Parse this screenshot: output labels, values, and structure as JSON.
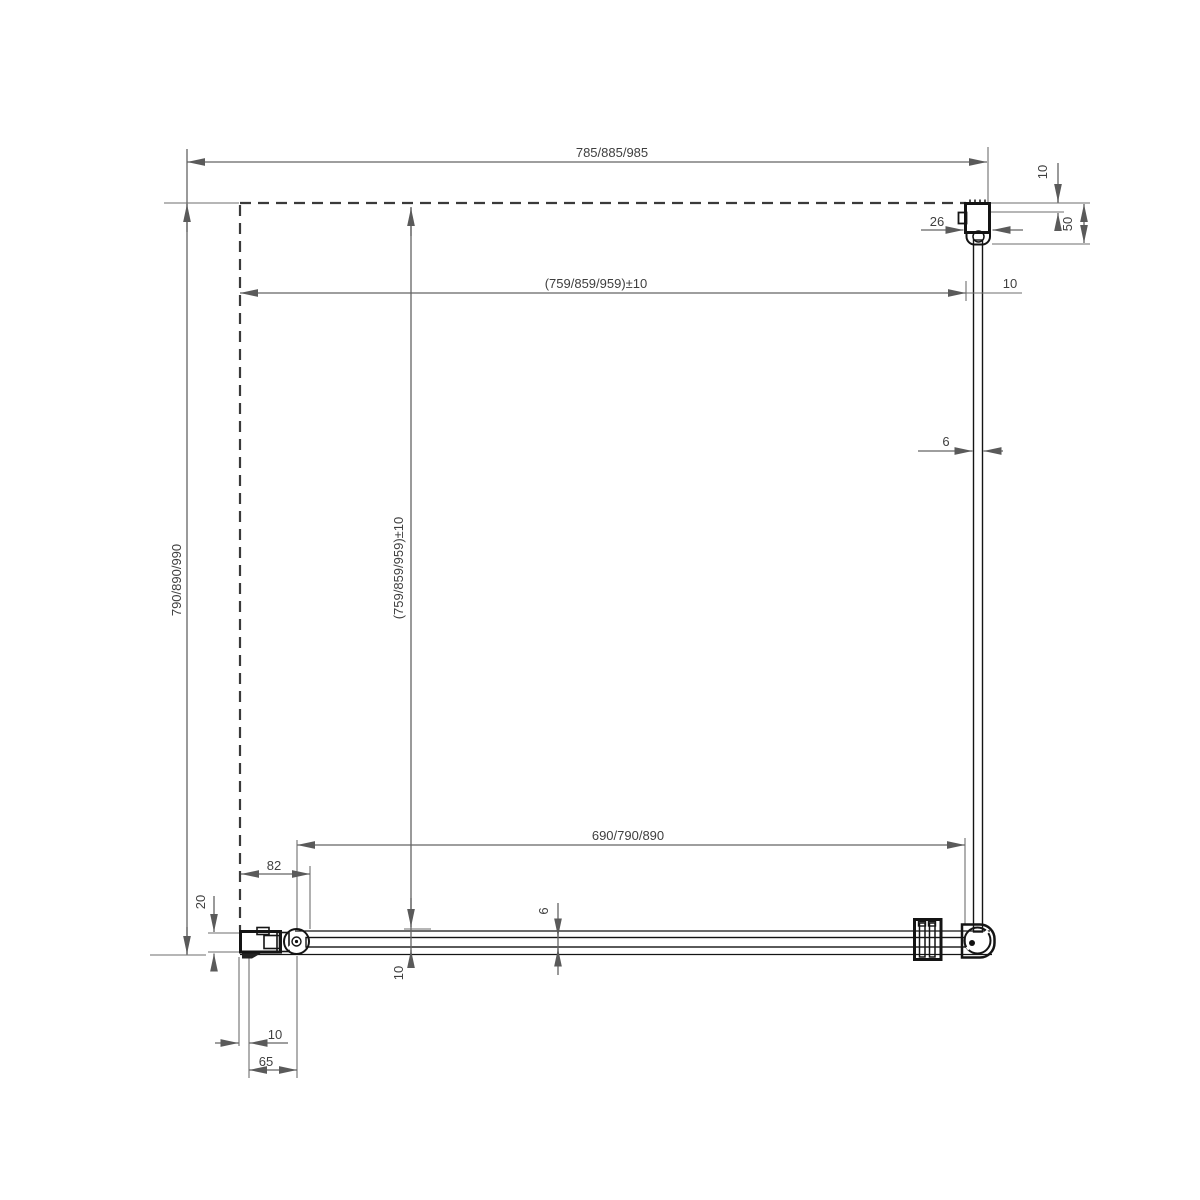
{
  "drawing": {
    "type": "technical-plan-drawing",
    "subject": "corner shower enclosure top view with wall profiles, hinge and corner connector",
    "line_color": "#141414",
    "dimension_color": "#636363",
    "background": "#ffffff",
    "dimensions": {
      "overall_width_top": "785/885/985",
      "inner_width_top": "(759/859/959)±10",
      "overall_depth_left": "790/890/990",
      "inner_depth_middle": "(759/859/959)±10",
      "front_glass_width": "690/790/890",
      "hinge_offset": "82",
      "wall_profile_plan_depth": "20",
      "glass_inset_front": "10",
      "glass_thickness_front": "6",
      "profile_adjust_bottom": "10",
      "profile_width_bottom": "65",
      "glass_thickness_side": "6",
      "wall_profile_width_top": "26",
      "profile_adjust_top": "10",
      "wall_profile_depth_top": "50",
      "glass_inset_side": "10"
    }
  }
}
